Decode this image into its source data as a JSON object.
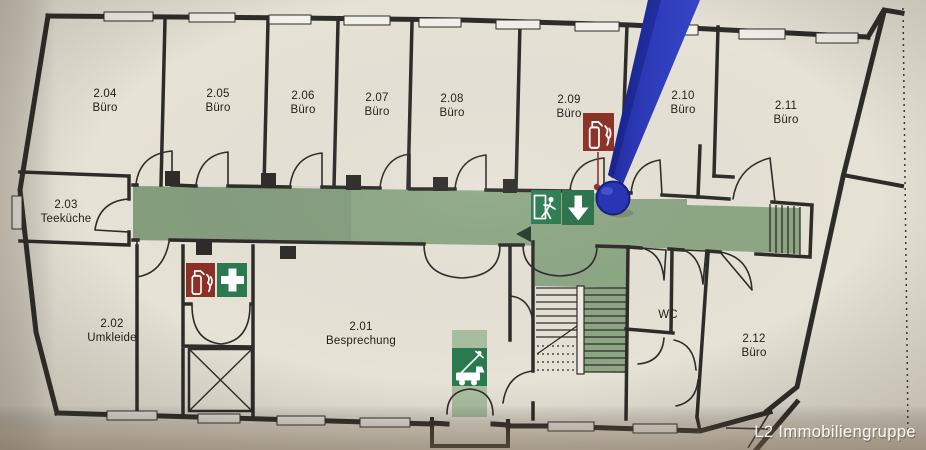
{
  "plan": {
    "watermark": "L2 Immobiliengruppe",
    "rooms": {
      "r201": {
        "number": "2.01",
        "type": "Besprechung"
      },
      "r202": {
        "number": "2.02",
        "type": "Umkleide"
      },
      "r203": {
        "number": "2.03",
        "type": "Teeküche"
      },
      "r204": {
        "number": "2.04",
        "type": "Büro"
      },
      "r205": {
        "number": "2.05",
        "type": "Büro"
      },
      "r206": {
        "number": "2.06",
        "type": "Büro"
      },
      "r207": {
        "number": "2.07",
        "type": "Büro"
      },
      "r208": {
        "number": "2.08",
        "type": "Büro"
      },
      "r209": {
        "number": "2.09",
        "type": "Büro"
      },
      "r210": {
        "number": "2.10",
        "type": "Büro"
      },
      "r211": {
        "number": "2.11",
        "type": "Büro"
      },
      "r212": {
        "number": "2.12",
        "type": "Büro"
      },
      "wc": {
        "type": "WC"
      }
    },
    "symbols": {
      "emergency_exit": "emergency-exit-running-man",
      "escape_direction": "escape-direction-down-arrow",
      "fire_extinguisher": "fire-extinguisher",
      "first_aid": "first-aid-cross",
      "ladder_point": "fire-brigade-ladder-point",
      "pin": "location-pin"
    },
    "colors": {
      "paper": "#e7e2d6",
      "wall": "#2e2c28",
      "escape_route": "#8da785",
      "escape_route_light": "#a9bfa0",
      "safety_green": "#2a7a50",
      "fire_red": "#8c3026",
      "pin_blue": "#2a35b5"
    }
  }
}
